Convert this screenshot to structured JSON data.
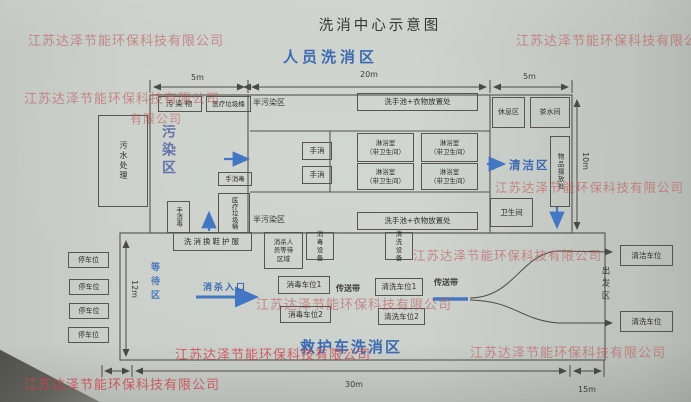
{
  "title": "洗消中心示意图",
  "watermark": {
    "text": "江苏达泽节能环保科技有限公司",
    "partial": "有限公司",
    "color": "#c25c5c"
  },
  "personnel_area": {
    "heading": "人员洗消区",
    "dims": {
      "left": "5m",
      "middle": "20m",
      "right": "5m",
      "height": "10m"
    },
    "zones": {
      "contaminated": "污染区",
      "semi_top": "半污染区",
      "semi_bottom": "半污染区",
      "clean": "清洁区"
    },
    "rooms": {
      "sewage": "污水处理",
      "pollutant": "污染物",
      "medical_waste_bin_top": "医疗垃圾桶",
      "medical_waste_bin_mid": "医疗垃圾桶",
      "hand_disinfect_mid": "手消毒",
      "hand_disinfect_left": "手消毒",
      "wash_basin_top": "洗手池+衣物放置处",
      "wash_basin_bottom": "洗手池+衣物放置处",
      "hand_wash": "手消",
      "shower": "淋浴室",
      "shower_sub": "（带卫生间）",
      "rest": "休息区",
      "tea": "茶水间",
      "items": "物品摆放处",
      "toilet": "卫生间",
      "change_row": "洗消换鞋护服"
    }
  },
  "ambulance_area": {
    "heading": "救护车洗消区",
    "dims": {
      "left_height": "12m",
      "bottom_middle": "30m",
      "bottom_right": "15m"
    },
    "labels": {
      "waiting": "等待区",
      "entrance": "消杀入口",
      "conveyor1": "传送带",
      "conveyor2": "传送带",
      "departure": "出发区"
    },
    "spots": {
      "parking": [
        "停车位",
        "停车位",
        "停车位",
        "停车位"
      ],
      "disinfect1": "消毒车位1",
      "disinfect2": "消毒车位2",
      "wash1": "清洗车位1",
      "wash2": "清洗车位2",
      "clean_exit_top": "清洁车位",
      "clean_exit_bottom": "清洗车位",
      "staff_wait": "消杀人员等待区域",
      "disinfect_equip": "消毒设备",
      "wash_equip": "清洗设备"
    }
  }
}
